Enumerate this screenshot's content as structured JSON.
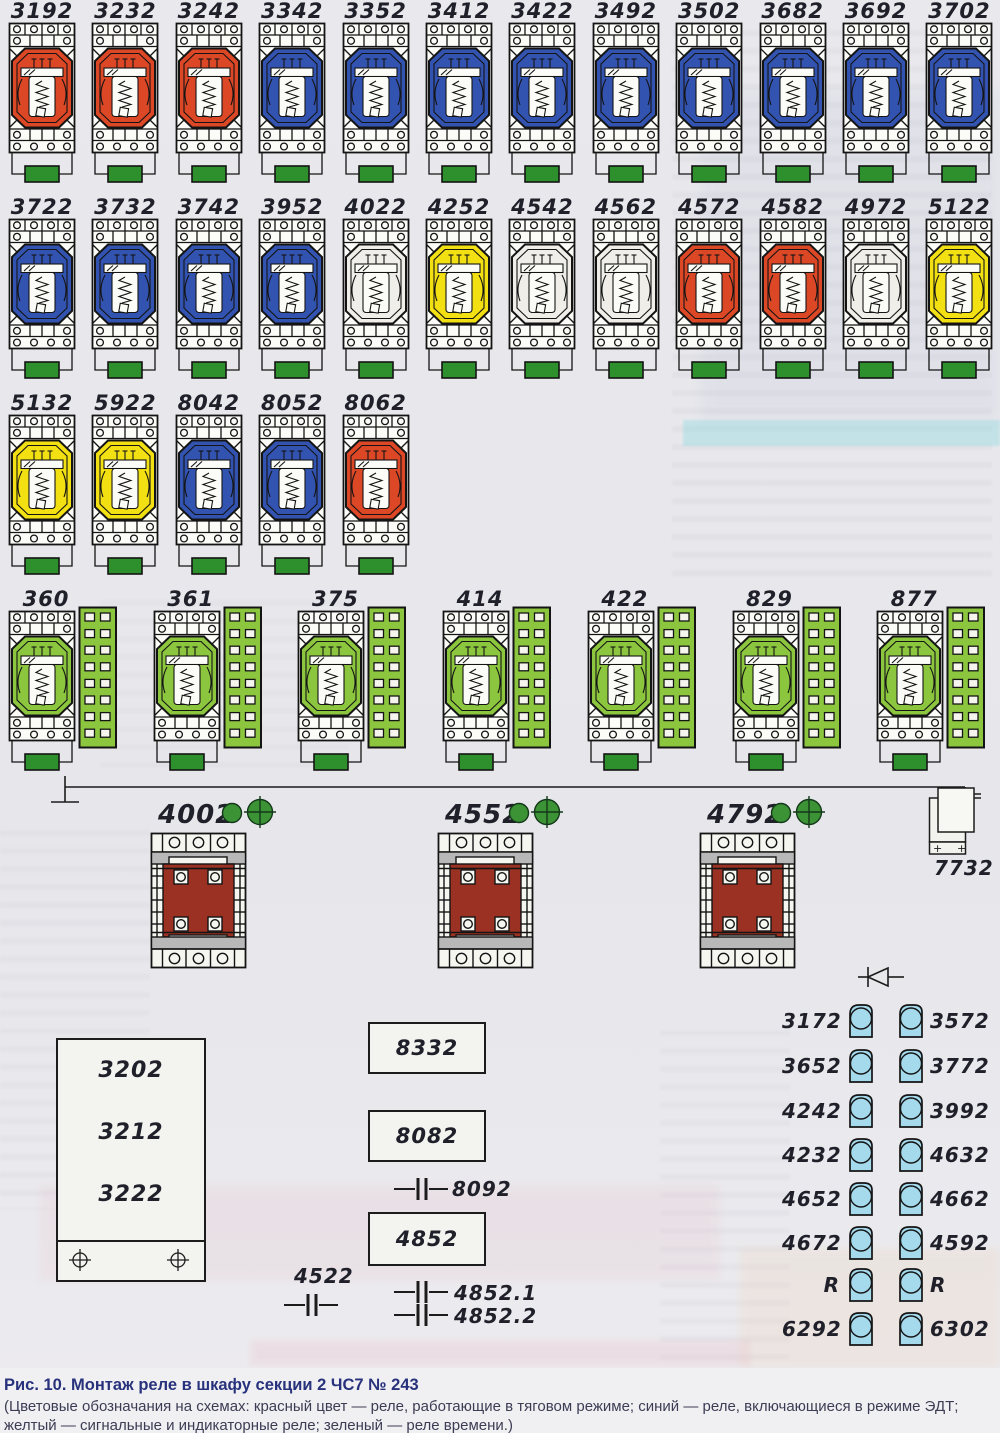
{
  "figure": {
    "caption_title": "Рис. 10. Монтаж реле в шкафу секции 2 ЧС7 № 243",
    "caption_body": "(Цветовые обозначания на схемах: красный цвет — реле, работающие в тяговом режиме; синий — реле, включающиеся в режиме ЭДТ; желтый — сигнальные и индикаторные реле; зеленый — реле времени.)"
  },
  "colors": {
    "red": "#dc4726",
    "blue": "#3253b0",
    "yellow": "#f3e013",
    "white": "#efeee8",
    "green": "#8cc63f",
    "dark_green": "#2e8f2d",
    "maroon": "#9b3122",
    "light_blue": "#a5d9ec",
    "outline": "#141414"
  },
  "relay_rows": [
    {
      "items": [
        {
          "label": "3192",
          "color": "red"
        },
        {
          "label": "3232",
          "color": "red"
        },
        {
          "label": "3242",
          "color": "red"
        },
        {
          "label": "3342",
          "color": "blue"
        },
        {
          "label": "3352",
          "color": "blue"
        },
        {
          "label": "3412",
          "color": "blue"
        },
        {
          "label": "3422",
          "color": "blue"
        },
        {
          "label": "3492",
          "color": "blue"
        },
        {
          "label": "3502",
          "color": "blue"
        },
        {
          "label": "3682",
          "color": "blue"
        },
        {
          "label": "3692",
          "color": "blue"
        },
        {
          "label": "3702",
          "color": "blue"
        }
      ]
    },
    {
      "items": [
        {
          "label": "3722",
          "color": "blue"
        },
        {
          "label": "3732",
          "color": "blue"
        },
        {
          "label": "3742",
          "color": "blue"
        },
        {
          "label": "3952",
          "color": "blue"
        },
        {
          "label": "4022",
          "color": "white"
        },
        {
          "label": "4252",
          "color": "yellow"
        },
        {
          "label": "4542",
          "color": "white"
        },
        {
          "label": "4562",
          "color": "white"
        },
        {
          "label": "4572",
          "color": "red"
        },
        {
          "label": "4582",
          "color": "red"
        },
        {
          "label": "4972",
          "color": "white"
        },
        {
          "label": "5122",
          "color": "yellow"
        }
      ]
    },
    {
      "items": [
        {
          "label": "5132",
          "color": "yellow"
        },
        {
          "label": "5922",
          "color": "yellow"
        },
        {
          "label": "8042",
          "color": "blue"
        },
        {
          "label": "8052",
          "color": "blue"
        },
        {
          "label": "8062",
          "color": "red"
        }
      ]
    }
  ],
  "timer_relays": {
    "items": [
      {
        "label": "360"
      },
      {
        "label": "361"
      },
      {
        "label": "375"
      },
      {
        "label": "414"
      },
      {
        "label": "422"
      },
      {
        "label": "829"
      },
      {
        "label": "877"
      }
    ]
  },
  "transformers": {
    "items": [
      {
        "label": "4002"
      },
      {
        "label": "4552"
      },
      {
        "label": "4792"
      }
    ],
    "stack_label": "7732",
    "stack_plus": "+"
  },
  "left_panel": {
    "labels": [
      "3202",
      "3212",
      "3222"
    ]
  },
  "mid_components": {
    "boxes": [
      "8332",
      "8082",
      "4852"
    ],
    "capacitors": [
      "8092",
      "4522",
      "4852.1",
      "4852.2"
    ]
  },
  "indicator_columns": {
    "left": [
      "3172",
      "3652",
      "4242",
      "4232",
      "4652",
      "4672",
      "R",
      "6292"
    ],
    "right": [
      "3572",
      "3772",
      "3992",
      "4632",
      "4662",
      "4592",
      "R",
      "6302"
    ]
  }
}
